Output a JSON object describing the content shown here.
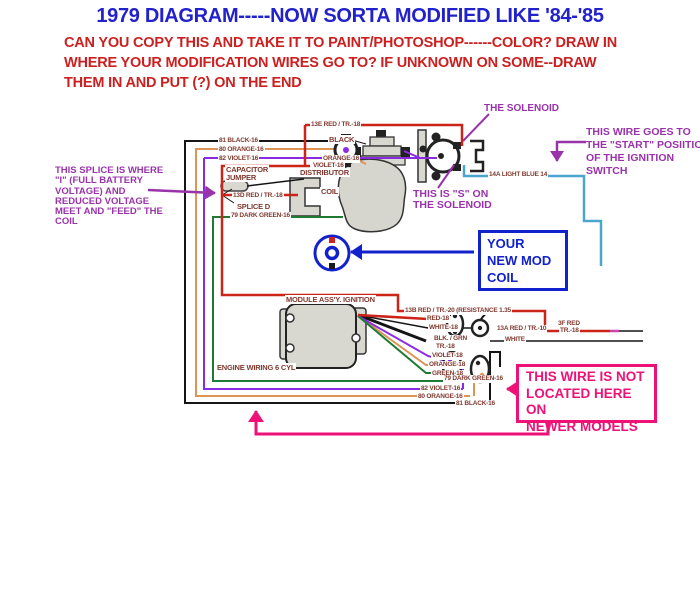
{
  "header": {
    "title": "1979 DIAGRAM-----NOW SORTA MODIFIED LIKE '84-'85",
    "instructions": [
      "CAN YOU COPY THIS AND TAKE IT TO PAINT/PHOTOSHOP------COLOR? DRAW IN",
      "WHERE YOUR MODIFICATION WIRES GO TO? IF UNKNOWN ON SOME--DRAW",
      "THEM IN AND PUT (?) ON THE END"
    ]
  },
  "annotations": {
    "solenoid_title": "THE SOLENOID",
    "start_wire": [
      "THIS WIRE GOES TO",
      "THE \"START\" POSIITION",
      "OF THE IGNITION",
      "SWITCH"
    ],
    "s_terminal": [
      "THIS IS \"S\" ON",
      "THE SOLENOID"
    ],
    "splice_note": [
      "THIS SPLICE IS WHERE",
      "\"I\" (FULL BATTERY",
      "VOLTAGE) AND",
      "REDUCED VOLTAGE",
      "MEET AND \"FEED\" THE",
      "COIL"
    ],
    "mod_coil_box": [
      "YOUR",
      "NEW MOD",
      "COIL"
    ],
    "not_located_box": [
      "THIS WIRE IS NOT",
      "LOCATED HERE ON",
      "NEWER MODELS"
    ]
  },
  "diagram": {
    "component_labels": {
      "capacitor_line1": "CAPACITOR",
      "capacitor_line2": "JUMPER",
      "splice_d": "SPLICE D",
      "black": "BLACK",
      "distributor": "DISTRIBUTOR",
      "coil": "COIL",
      "module": "MODULE ASS'Y. IGNITION",
      "engine_wiring": "ENGINE WIRING 6 CYL"
    },
    "wire_labels": {
      "top_black": "81 BLACK-16",
      "top_orange": "80 ORANGE-16",
      "top_violet": "82 VIOLET-16",
      "red_13e": "13E RED / TR.-18",
      "red_13d": "13D RED / TR.-18",
      "green_top": "79 DARK GREEN-16",
      "orange_dist": "ORANGE-16",
      "violet_dist": "VIOLET-16",
      "light_blue": "14A LIGHT BLUE 14",
      "red_13b": "13B RED / TR.-20 (RESISTANCE 1.35",
      "red_18": "RED-18",
      "white_18": "WHITE-18",
      "blk_grn_1": "BLK. / GRN",
      "blk_grn_2": "TR.-18",
      "violet_18": "VIOLET-18",
      "orange_18": "ORANGE-18",
      "green_18": "GREEN-18",
      "red_13a": "13A RED / TR.-10",
      "red_3f_1": "3F RED",
      "red_3f_2": "TR.-18",
      "white": "WHITE",
      "bot_green": "79 DARK GREEN-16",
      "bot_violet": "82 VIOLET-16",
      "bot_orange": "80 ORANGE-16",
      "bot_black": "81 BLACK-16"
    },
    "colors": {
      "title_blue": "#2222cc",
      "instruction_red": "#cc2020",
      "annotation_purple": "#9933aa",
      "callout_pink": "#ee1177",
      "mod_coil_blue": "#1122cc",
      "wire_red": "#cc2418",
      "wire_orange": "#dd9455",
      "wire_violet": "#8a2be2",
      "wire_green": "#1f7a33",
      "wire_black": "#151515",
      "wire_light_blue": "#4ba6cf",
      "label_maroon": "#80392f"
    }
  }
}
